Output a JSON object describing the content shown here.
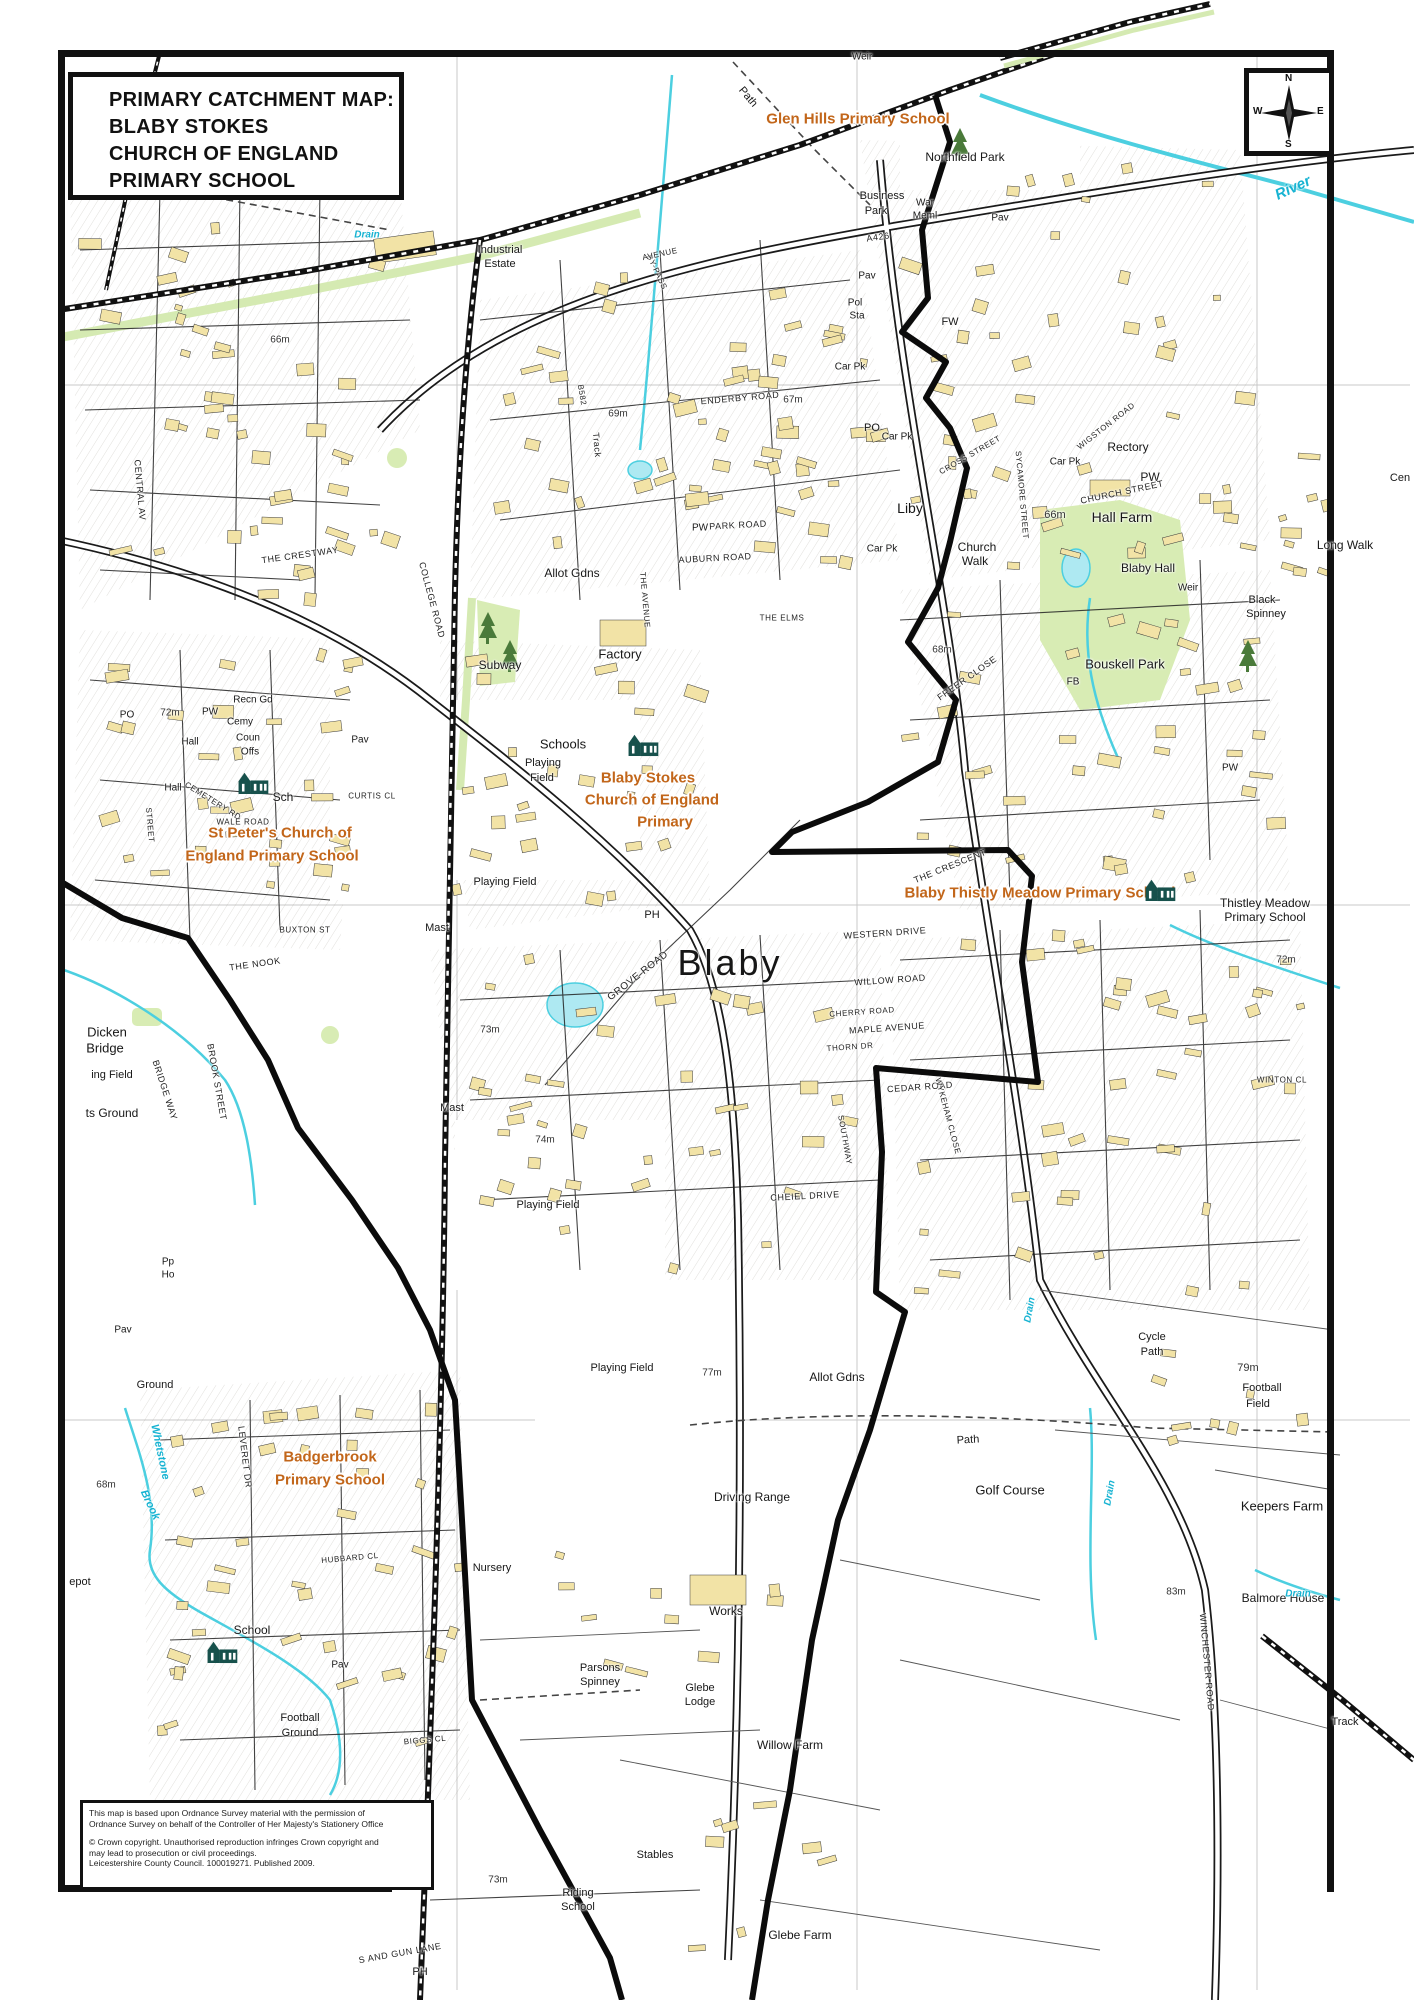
{
  "title_box": {
    "lines": [
      "PRIMARY CATCHMENT MAP:",
      "BLABY STOKES",
      "CHURCH OF ENGLAND",
      "PRIMARY SCHOOL"
    ]
  },
  "compass": {
    "n": "N",
    "e": "E",
    "s": "S",
    "w": "W"
  },
  "attribution": {
    "line1": "This map is based upon Ordnance Survey material with the permission of",
    "line2": "Ordnance Survey on behalf of the Controller of Her Majesty's Stationery Office",
    "line3": "© Crown copyright. Unauthorised reproduction infringes Crown copyright and",
    "line4": "may lead to prosecution or civil proceedings.",
    "line5": "Leicestershire County Council. 100019271. Published 2009."
  },
  "colors": {
    "building": "#f2e3a6",
    "green": "#d8ecb4",
    "water": "#4ccfe0",
    "boundary": "#0b0b0b",
    "school_label": "#c2661a",
    "school_icon": "#17514c"
  },
  "school_icons": [
    [
      643,
      745
    ],
    [
      253,
      783
    ],
    [
      1160,
      890
    ],
    [
      222,
      1652
    ]
  ],
  "map_labels": [
    [
      "Glen Hills Primary School",
      858,
      119,
      15,
      0,
      "s"
    ],
    [
      "Blaby Stokes",
      648,
      778,
      15,
      0,
      "s"
    ],
    [
      "Church of England",
      652,
      800,
      15,
      0,
      "s"
    ],
    [
      "Primary",
      665,
      822,
      15,
      0,
      "s"
    ],
    [
      "St Peter's Church of",
      280,
      833,
      15,
      0,
      "s"
    ],
    [
      "England Primary School",
      272,
      856,
      15,
      0,
      "s"
    ],
    [
      "Blaby Thistly Meadow Primary School",
      1040,
      893,
      15,
      0,
      "s"
    ],
    [
      "Badgerbrook",
      330,
      1457,
      15,
      0,
      "s"
    ],
    [
      "Primary School",
      330,
      1480,
      15,
      0,
      "s"
    ],
    [
      "Blaby",
      730,
      963,
      36,
      0,
      "c"
    ],
    [
      "Northfield Park",
      965,
      157,
      12,
      0,
      "p"
    ],
    [
      "Business",
      882,
      196,
      11,
      0,
      "p"
    ],
    [
      "Park",
      876,
      211,
      11,
      0,
      "p"
    ],
    [
      "War",
      925,
      203,
      10,
      0,
      "p"
    ],
    [
      "Meml",
      925,
      216,
      10,
      0,
      "p"
    ],
    [
      "Pav",
      1000,
      218,
      10,
      0,
      "p"
    ],
    [
      "Weir",
      862,
      57,
      10,
      0,
      "p"
    ],
    [
      "Industrial",
      500,
      250,
      11,
      0,
      "p"
    ],
    [
      "Estate",
      500,
      264,
      11,
      0,
      "p"
    ],
    [
      "Pol",
      855,
      303,
      10,
      0,
      "p"
    ],
    [
      "Sta",
      857,
      316,
      10,
      0,
      "p"
    ],
    [
      "FW",
      950,
      322,
      11,
      0,
      "p"
    ],
    [
      "Car Pk",
      897,
      437,
      10,
      0,
      "p"
    ],
    [
      "Car Pk",
      882,
      549,
      10,
      0,
      "p"
    ],
    [
      "Car Pk",
      1065,
      462,
      10,
      0,
      "p"
    ],
    [
      "Car Pk",
      850,
      367,
      10,
      0,
      "p"
    ],
    [
      "PO",
      872,
      428,
      11,
      0,
      "p"
    ],
    [
      "Liby",
      910,
      508,
      14,
      0,
      "p"
    ],
    [
      "Rectory",
      1128,
      447,
      12,
      0,
      "p"
    ],
    [
      "PW",
      1150,
      477,
      12,
      0,
      "p"
    ],
    [
      "Hall Farm",
      1122,
      517,
      14,
      0,
      "p"
    ],
    [
      "66m",
      1055,
      515,
      11,
      0,
      "m"
    ],
    [
      "Blaby Hall",
      1148,
      568,
      12,
      0,
      "p"
    ],
    [
      "Bouskell Park",
      1125,
      664,
      13,
      0,
      "p"
    ],
    [
      "FB",
      1073,
      682,
      10,
      0,
      "p"
    ],
    [
      "Black",
      1262,
      600,
      11,
      0,
      "p"
    ],
    [
      "Spinney",
      1266,
      614,
      11,
      0,
      "p"
    ],
    [
      "Long Walk",
      1345,
      545,
      12,
      0,
      "p"
    ],
    [
      "Weir",
      1188,
      588,
      10,
      0,
      "p"
    ],
    [
      "Cen",
      1400,
      478,
      11,
      0,
      "p"
    ],
    [
      "Church",
      977,
      547,
      12,
      0,
      "p"
    ],
    [
      "Walk",
      975,
      561,
      12,
      0,
      "p"
    ],
    [
      "67m",
      793,
      400,
      10,
      0,
      "m"
    ],
    [
      "69m",
      618,
      414,
      10,
      0,
      "m"
    ],
    [
      "Subway",
      500,
      665,
      12,
      0,
      "p"
    ],
    [
      "Factory",
      620,
      654,
      13,
      0,
      "p"
    ],
    [
      "Allot Gdns",
      572,
      573,
      12,
      0,
      "p"
    ],
    [
      "Schools",
      563,
      744,
      13,
      0,
      "p"
    ],
    [
      "Playing",
      543,
      763,
      11,
      0,
      "p"
    ],
    [
      "Field",
      542,
      778,
      11,
      0,
      "p"
    ],
    [
      "Playing Field",
      505,
      882,
      11,
      0,
      "p"
    ],
    [
      "Playing Field",
      548,
      1205,
      11,
      0,
      "p"
    ],
    [
      "Playing Field",
      622,
      1368,
      11,
      0,
      "p"
    ],
    [
      "Mast",
      437,
      928,
      11,
      0,
      "p"
    ],
    [
      "Mast",
      452,
      1108,
      11,
      0,
      "p"
    ],
    [
      "73m",
      490,
      1030,
      10,
      0,
      "m"
    ],
    [
      "68m",
      942,
      650,
      10,
      0,
      "m"
    ],
    [
      "72m",
      1286,
      960,
      10,
      0,
      "m"
    ],
    [
      "72m",
      170,
      713,
      10,
      0,
      "m"
    ],
    [
      "74m",
      545,
      1140,
      10,
      0,
      "m"
    ],
    [
      "PH",
      652,
      915,
      11,
      0,
      "p"
    ],
    [
      "PH",
      420,
      1972,
      11,
      0,
      "p"
    ],
    [
      "73m",
      498,
      1880,
      10,
      0,
      "m"
    ],
    [
      "77m",
      712,
      1373,
      10,
      0,
      "m"
    ],
    [
      "Allot Gdns",
      837,
      1377,
      12,
      0,
      "p"
    ],
    [
      "Cycle",
      1152,
      1337,
      11,
      0,
      "p"
    ],
    [
      "Path",
      1152,
      1352,
      11,
      0,
      "p"
    ],
    [
      "79m",
      1248,
      1368,
      11,
      0,
      "m"
    ],
    [
      "Football",
      1262,
      1388,
      11,
      0,
      "p"
    ],
    [
      "Field",
      1258,
      1404,
      11,
      0,
      "p"
    ],
    [
      "Thistley Meadow",
      1265,
      903,
      12,
      0,
      "p"
    ],
    [
      "Primary School",
      1265,
      917,
      12,
      0,
      "p"
    ],
    [
      "Golf Course",
      1010,
      1490,
      13,
      0,
      "p"
    ],
    [
      "Path",
      968,
      1440,
      11,
      -3,
      "p"
    ],
    [
      "Path",
      748,
      97,
      11,
      50,
      "p"
    ],
    [
      "Driving Range",
      752,
      1497,
      12,
      0,
      "p"
    ],
    [
      "Works",
      726,
      1611,
      12,
      0,
      "p"
    ],
    [
      "Nursery",
      492,
      1568,
      11,
      0,
      "p"
    ],
    [
      "Parsons",
      600,
      1668,
      11,
      0,
      "p"
    ],
    [
      "Spinney",
      600,
      1682,
      11,
      0,
      "p"
    ],
    [
      "Glebe",
      700,
      1688,
      11,
      0,
      "p"
    ],
    [
      "Lodge",
      700,
      1702,
      11,
      0,
      "p"
    ],
    [
      "Willow Farm",
      790,
      1745,
      12,
      0,
      "p"
    ],
    [
      "Stables",
      655,
      1855,
      11,
      0,
      "p"
    ],
    [
      "Riding",
      578,
      1893,
      11,
      0,
      "p"
    ],
    [
      "School",
      578,
      1907,
      11,
      0,
      "p"
    ],
    [
      "Glebe Farm",
      800,
      1935,
      12,
      0,
      "p"
    ],
    [
      "Keepers Farm",
      1282,
      1506,
      13,
      0,
      "p"
    ],
    [
      "Balmore House",
      1283,
      1598,
      12,
      0,
      "p"
    ],
    [
      "83m",
      1176,
      1592,
      10,
      0,
      "m"
    ],
    [
      "Dicken",
      107,
      1032,
      13,
      0,
      "p"
    ],
    [
      "Bridge",
      105,
      1048,
      13,
      0,
      "p"
    ],
    [
      "ing Field",
      112,
      1075,
      11,
      0,
      "p"
    ],
    [
      "ts Ground",
      112,
      1113,
      12,
      0,
      "p"
    ],
    [
      "Recn Gd",
      253,
      700,
      10,
      0,
      "p"
    ],
    [
      "Cemy",
      240,
      722,
      10,
      0,
      "p"
    ],
    [
      "Coun",
      248,
      738,
      10,
      0,
      "p"
    ],
    [
      "Offs",
      250,
      752,
      10,
      0,
      "p"
    ],
    [
      "Hall",
      190,
      742,
      10,
      0,
      "p"
    ],
    [
      "Hall",
      173,
      788,
      10,
      0,
      "p"
    ],
    [
      "PO",
      127,
      715,
      10,
      0,
      "p"
    ],
    [
      "PW",
      210,
      712,
      10,
      0,
      "p"
    ],
    [
      "PW",
      700,
      528,
      10,
      0,
      "p"
    ],
    [
      "PW",
      1230,
      768,
      10,
      0,
      "p"
    ],
    [
      "Sch",
      283,
      797,
      12,
      0,
      "p"
    ],
    [
      "School",
      252,
      1630,
      12,
      0,
      "p"
    ],
    [
      "Pav",
      340,
      1665,
      10,
      0,
      "p"
    ],
    [
      "Pav",
      360,
      740,
      10,
      0,
      "p"
    ],
    [
      "Pav",
      867,
      276,
      10,
      0,
      "p"
    ],
    [
      "Pav",
      123,
      1330,
      10,
      0,
      "p"
    ],
    [
      "Football",
      300,
      1718,
      11,
      0,
      "p"
    ],
    [
      "Ground",
      300,
      1733,
      11,
      0,
      "p"
    ],
    [
      "Ground",
      155,
      1385,
      11,
      0,
      "p"
    ],
    [
      "Pp",
      168,
      1262,
      10,
      0,
      "p"
    ],
    [
      "Ho",
      168,
      1275,
      10,
      0,
      "p"
    ],
    [
      "epot",
      80,
      1582,
      11,
      0,
      "p"
    ],
    [
      "68m",
      106,
      1485,
      10,
      0,
      "m"
    ],
    [
      "66m",
      280,
      340,
      10,
      0,
      "m"
    ],
    [
      "Track",
      1345,
      1722,
      11,
      0,
      "p"
    ],
    [
      "Track",
      597,
      445,
      9,
      85,
      "r"
    ],
    [
      "ENDERBY ROAD",
      740,
      398,
      9,
      -5,
      "r"
    ],
    [
      "PARK ROAD",
      738,
      525,
      9,
      -3,
      "r"
    ],
    [
      "AUBURN ROAD",
      715,
      558,
      9,
      -3,
      "r"
    ],
    [
      "GROVE ROAD",
      638,
      976,
      10,
      -38,
      "r"
    ],
    [
      "CHURCH STREET",
      1122,
      492,
      9,
      -12,
      "r"
    ],
    [
      "CROSS STREET",
      970,
      455,
      8,
      -30,
      "r"
    ],
    [
      "SYCAMORE STREET",
      1022,
      495,
      8,
      85,
      "r"
    ],
    [
      "WIGSTON ROAD",
      1106,
      426,
      8,
      -38,
      "r"
    ],
    [
      "FREER CLOSE",
      967,
      678,
      9,
      -35,
      "r"
    ],
    [
      "THE CRESCENT",
      950,
      866,
      9,
      -22,
      "r"
    ],
    [
      "WESTERN DRIVE",
      885,
      933,
      9,
      -4,
      "r"
    ],
    [
      "WILLOW ROAD",
      890,
      980,
      9,
      -4,
      "r"
    ],
    [
      "MAPLE AVENUE",
      887,
      1028,
      9,
      -4,
      "r"
    ],
    [
      "CHERRY ROAD",
      862,
      1012,
      8,
      -4,
      "r"
    ],
    [
      "THORN DR",
      850,
      1047,
      8,
      -4,
      "r"
    ],
    [
      "CEDAR ROAD",
      920,
      1087,
      9,
      -4,
      "r"
    ],
    [
      "WYKEHAM CLOSE",
      948,
      1116,
      8,
      75,
      "r"
    ],
    [
      "SOUTHWAY",
      845,
      1140,
      8,
      80,
      "r"
    ],
    [
      "CHEIEL DRIVE",
      805,
      1196,
      9,
      -3,
      "r"
    ],
    [
      "COLLEGE ROAD",
      432,
      600,
      9,
      75,
      "r"
    ],
    [
      "THE AVENUE",
      645,
      600,
      8,
      85,
      "r"
    ],
    [
      "B582",
      582,
      395,
      8,
      80,
      "r"
    ],
    [
      "BY-PASS",
      657,
      272,
      8,
      65,
      "r"
    ],
    [
      "AVENUE",
      660,
      254,
      8,
      -12,
      "r"
    ],
    [
      "A426",
      878,
      237,
      9,
      -8,
      "r"
    ],
    [
      "WINCHESTER ROAD",
      1207,
      1662,
      9,
      85,
      "r"
    ],
    [
      "THE NOOK",
      255,
      964,
      9,
      -8,
      "r"
    ],
    [
      "BROOK STREET",
      217,
      1082,
      9,
      80,
      "r"
    ],
    [
      "BRIDGE WAY",
      165,
      1090,
      9,
      72,
      "r"
    ],
    [
      "CEMETERY RD",
      213,
      801,
      8,
      32,
      "r"
    ],
    [
      "WALE ROAD",
      243,
      822,
      8,
      0,
      "r"
    ],
    [
      "CURTIS CL",
      372,
      796,
      8,
      0,
      "r"
    ],
    [
      "THE CRESTWAY",
      300,
      555,
      9,
      -8,
      "r"
    ],
    [
      "CENTRAL AV",
      140,
      490,
      9,
      85,
      "r"
    ],
    [
      "STREET",
      150,
      825,
      8,
      85,
      "r"
    ],
    [
      "BUXTON ST",
      305,
      930,
      8,
      0,
      "r"
    ],
    [
      "LEVERET DR",
      245,
      1457,
      9,
      83,
      "r"
    ],
    [
      "BIGGS CL",
      425,
      1740,
      8,
      -5,
      "r"
    ],
    [
      "S AND GUN LANE",
      400,
      1953,
      9,
      -10,
      "r"
    ],
    [
      "WINTON CL",
      1282,
      1080,
      8,
      0,
      "r"
    ],
    [
      "HUBBARD CL",
      350,
      1558,
      8,
      -5,
      "r"
    ],
    [
      "THE ELMS",
      782,
      618,
      8,
      0,
      "r"
    ],
    [
      "Drain",
      367,
      235,
      10,
      0,
      "w"
    ],
    [
      "Drain",
      1110,
      1493,
      10,
      -80,
      "w"
    ],
    [
      "Drain",
      1030,
      1310,
      10,
      -80,
      "w"
    ],
    [
      "Drain",
      1298,
      1594,
      10,
      0,
      "w"
    ],
    [
      "River",
      1293,
      188,
      15,
      -25,
      "w"
    ],
    [
      "Whetstone",
      160,
      1452,
      11,
      78,
      "w"
    ],
    [
      "Brook",
      150,
      1505,
      11,
      65,
      "w"
    ]
  ]
}
